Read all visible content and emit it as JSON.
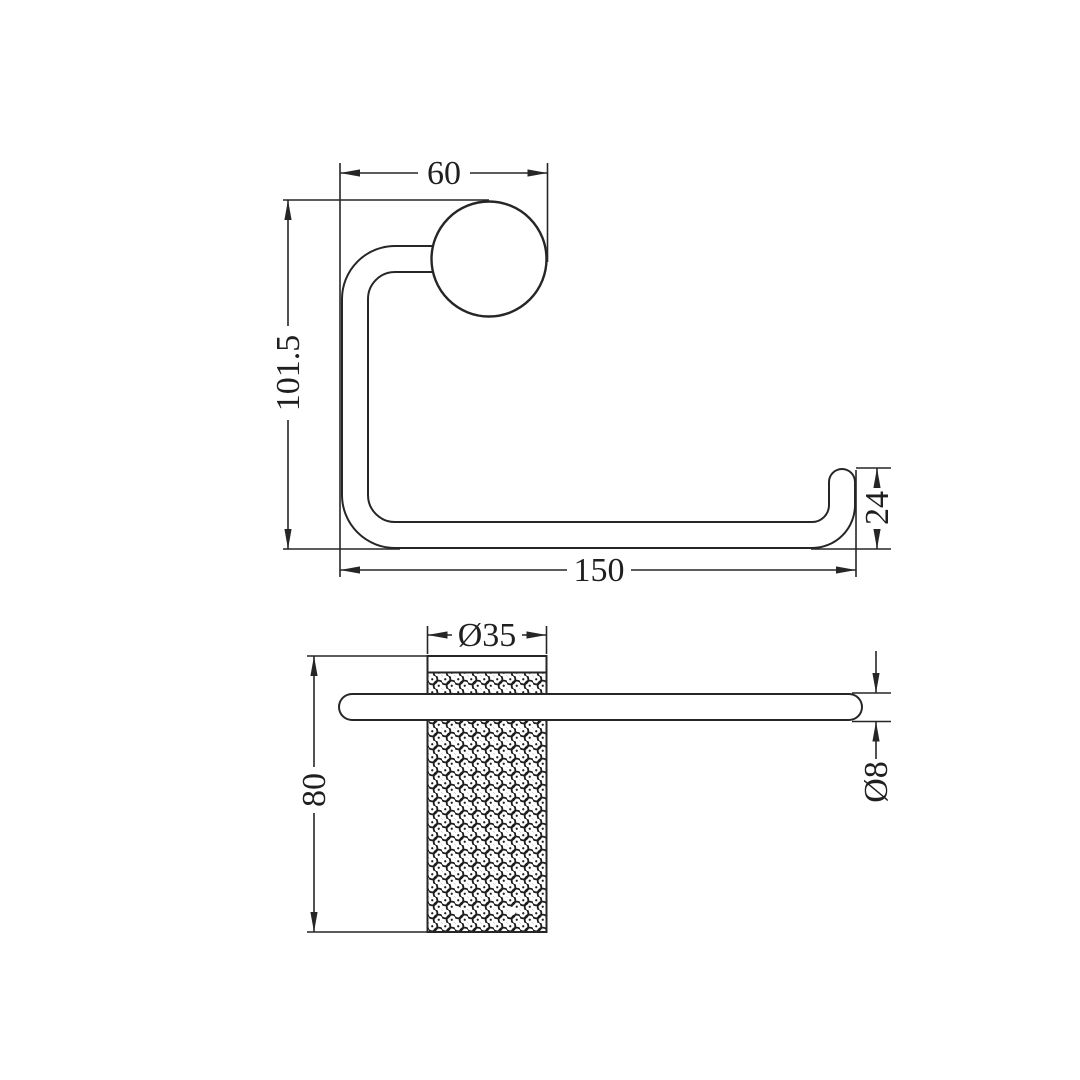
{
  "drawing": {
    "type": "technical-dimension-drawing",
    "views": {
      "front_view": {
        "dims": {
          "flange_offset": "60",
          "overall_height": "101.5",
          "overall_length": "150",
          "hook_height": "24"
        }
      },
      "side_view": {
        "dims": {
          "flange_diameter": "Ø35",
          "flange_length": "80",
          "rail_diameter": "Ø8"
        }
      }
    },
    "colors": {
      "line": "#262626",
      "text": "#1f1f1f",
      "background": "#ffffff"
    }
  }
}
